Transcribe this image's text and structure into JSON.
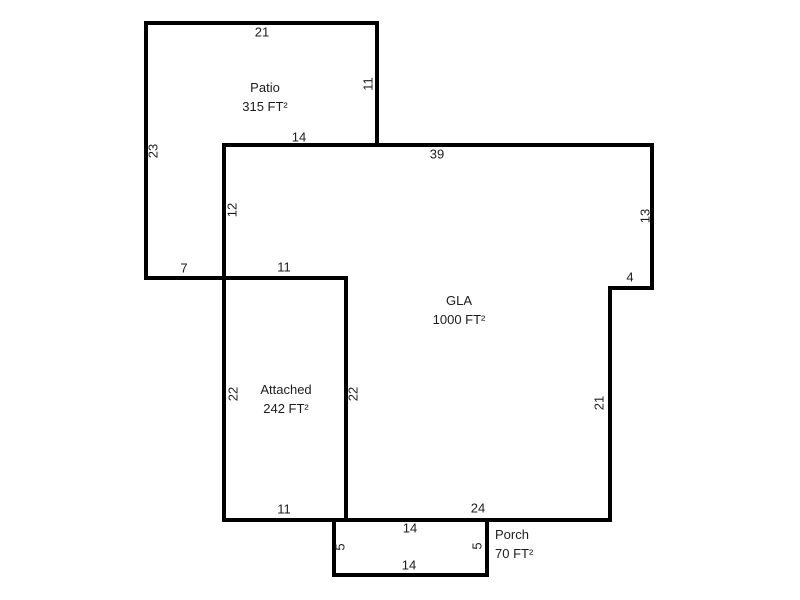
{
  "floorplan": {
    "background_color": "#ffffff",
    "wall_color": "#000000",
    "text_color": "#1c1c1c",
    "areas": {
      "patio": {
        "name": "Patio",
        "area": "315 FT²"
      },
      "gla": {
        "name": "GLA",
        "area": "1000 FT²"
      },
      "attached": {
        "name": "Attached",
        "area": "242 FT²"
      },
      "porch": {
        "name": "Porch",
        "area": "70 FT²"
      }
    },
    "dimensions": {
      "patio_top": "21",
      "patio_right": "11",
      "patio_left": "23",
      "patio_bottom": "14",
      "patio_lower_bottom": "7",
      "gla_top": "39",
      "gla_upper_left": "12",
      "gla_upper_right": "13",
      "gla_step": "4",
      "gla_lower_right": "21",
      "gla_bottom": "24",
      "attached_top": "11",
      "attached_left": "22",
      "attached_right": "22",
      "attached_bottom": "11",
      "porch_top": "14",
      "porch_bottom": "14",
      "porch_left": "5",
      "porch_right": "5"
    }
  }
}
